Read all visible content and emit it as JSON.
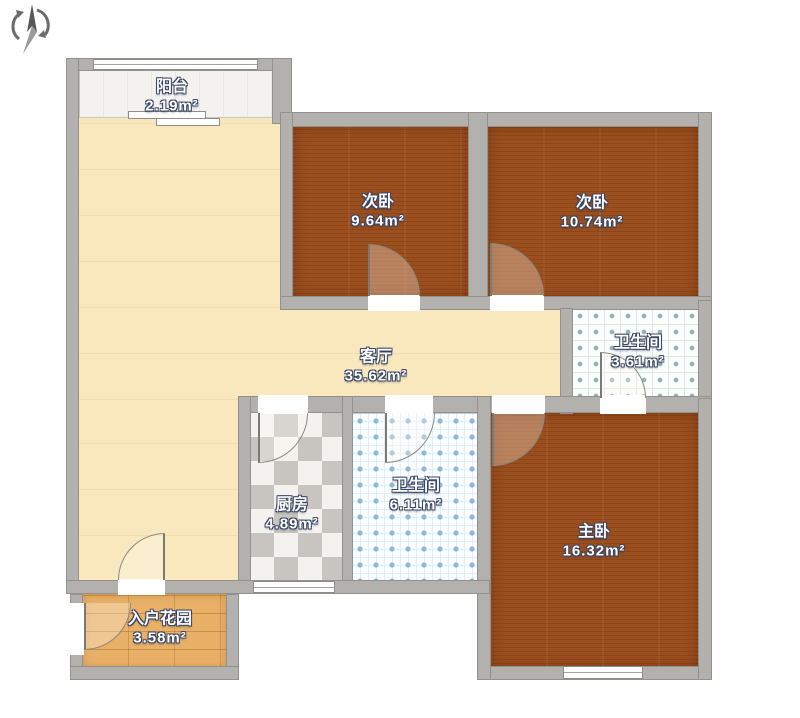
{
  "plan_title": "3-room floor plan",
  "compass": {
    "icon": "north-compass-icon"
  },
  "rooms": {
    "balcony": {
      "name": "阳台",
      "area": "2.19m²"
    },
    "bedroom_left": {
      "name": "次卧",
      "area": "9.64m²"
    },
    "bedroom_right": {
      "name": "次卧",
      "area": "10.74m²"
    },
    "living_room": {
      "name": "客厅",
      "area": "35.62m²"
    },
    "bathroom_small": {
      "name": "卫生间",
      "area": "3.61m²"
    },
    "kitchen": {
      "name": "厨房",
      "area": "4.89m²"
    },
    "bathroom_large": {
      "name": "卫生间",
      "area": "6.11m²"
    },
    "master_bedroom": {
      "name": "主卧",
      "area": "16.32m²"
    },
    "entry_garden": {
      "name": "入户花园",
      "area": "3.58m²"
    }
  },
  "colors": {
    "wall": "#b3b1ad",
    "bedroom_wood": "#9c4f1e",
    "living_cream": "#f9e8bd",
    "garden_wood": "#e9b168",
    "kitchen_tile_dark": "#c8c5c1",
    "bath_dot_teal": "#8fb6b2",
    "bath_dot_blue": "#8bb8d5",
    "label_text": "#ffffff",
    "label_outline": "#3a4663"
  }
}
